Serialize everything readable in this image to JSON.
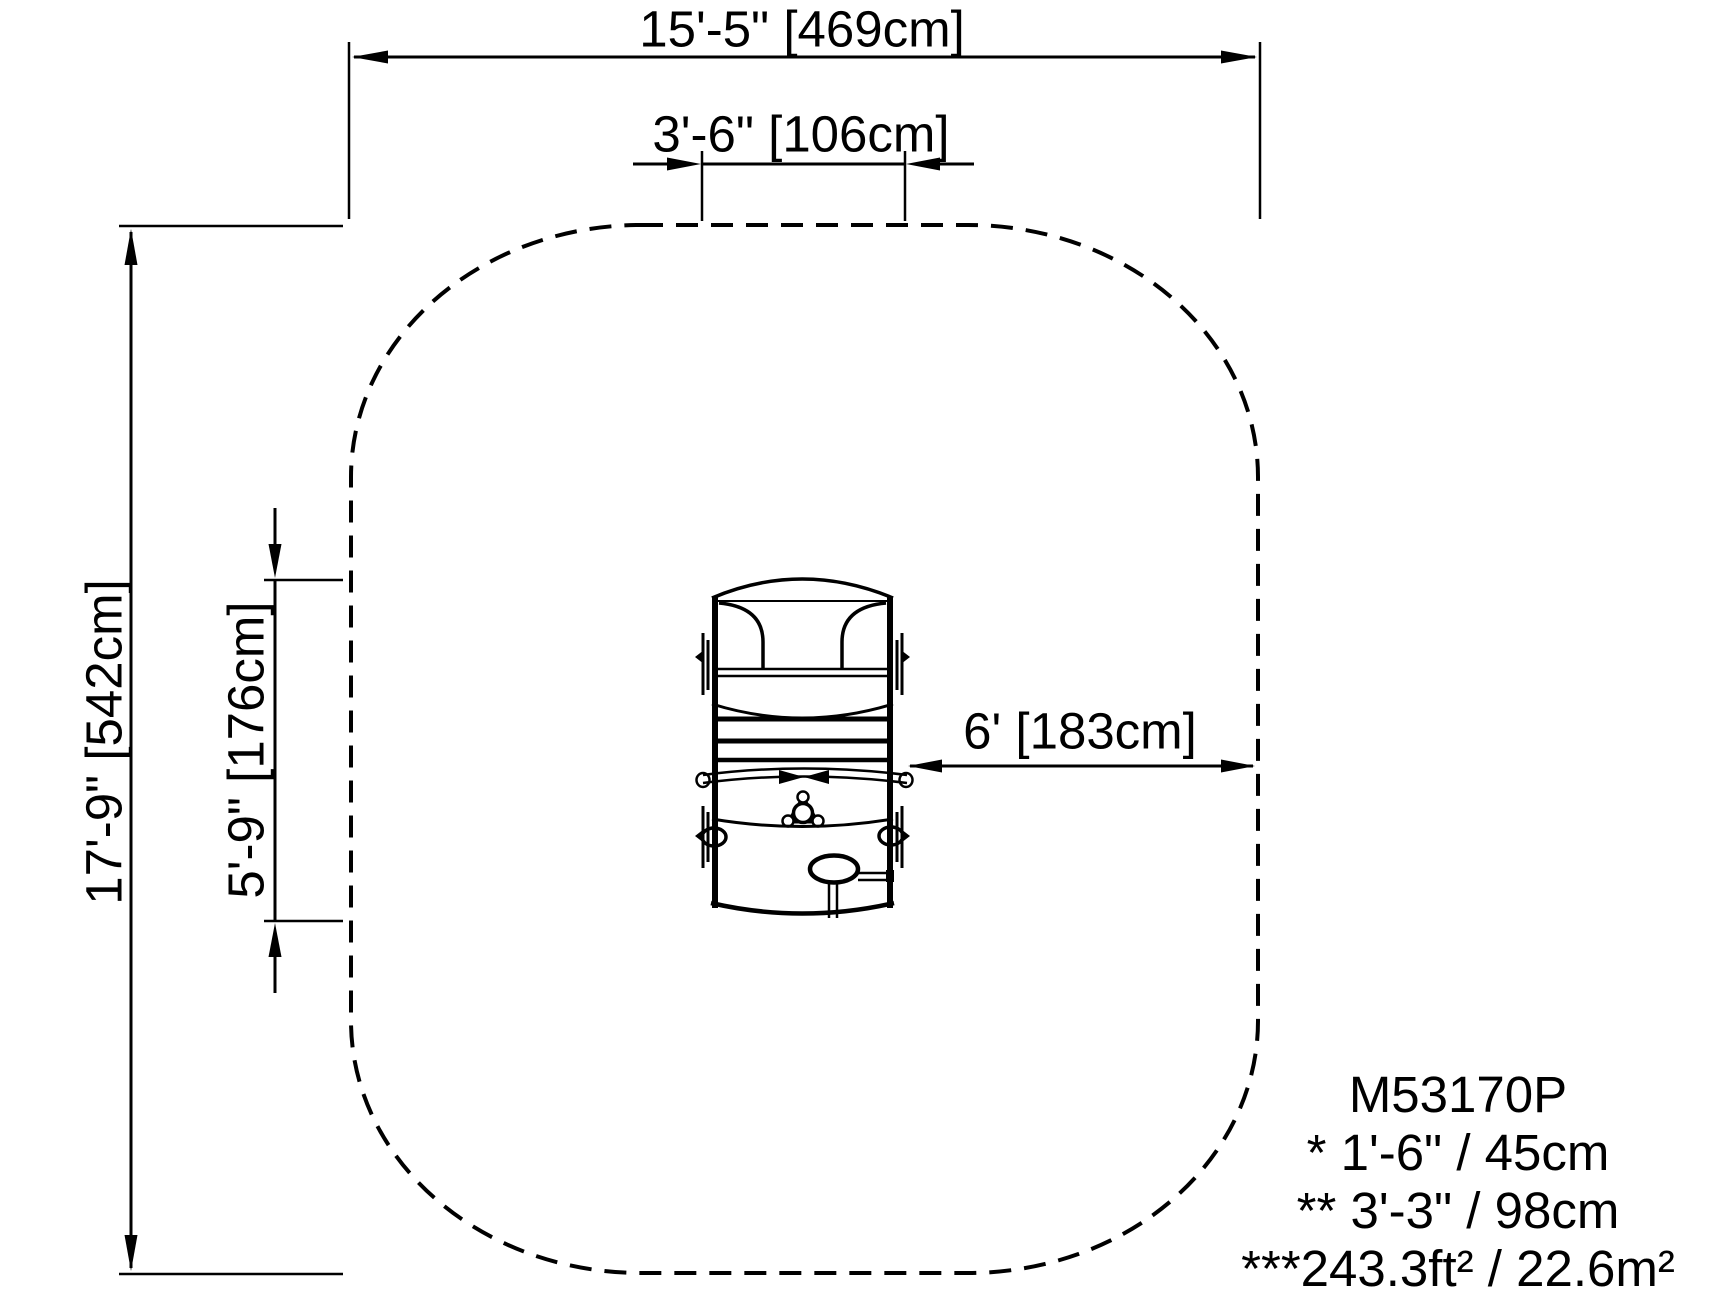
{
  "drawing": {
    "dimensions": {
      "overall_width": "15'-5\" [469cm]",
      "equipment_width": "3'-6\" [106cm]",
      "overall_depth": "17'-9\" [542cm]",
      "equipment_depth": "5'-9\" [176cm]",
      "use_zone_clearance": "6' [183cm]"
    },
    "legend": {
      "model": "M53170P",
      "notes": [
        "* 1'-6\" / 45cm",
        "** 3'-3\" / 98cm",
        "***243.3ft² / 22.6m²"
      ]
    },
    "colors": {
      "ink": "#000000",
      "paper": "#ffffff"
    }
  }
}
